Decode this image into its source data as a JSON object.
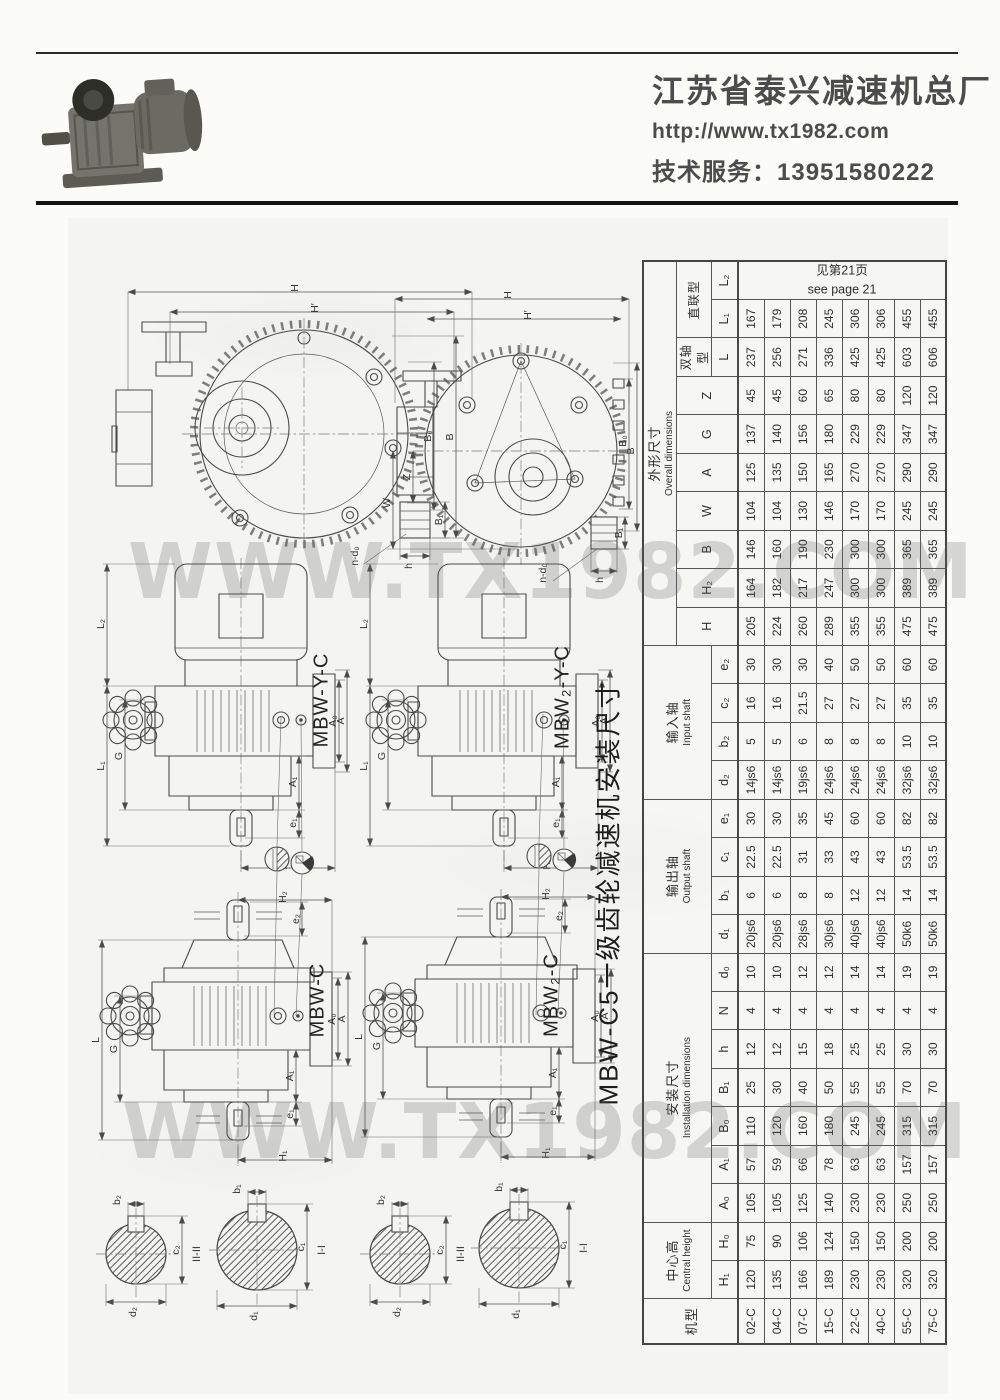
{
  "header": {
    "company": "江苏省泰兴减速机总厂",
    "website": "http://www.tx1982.com",
    "service": "技术服务：13951580222"
  },
  "watermark": "WWW.TX1982.COM",
  "title_vertical": "MBW-C5一级齿轮减速机安装尺寸",
  "drawings": {
    "labels": [
      "MBW-Y-C",
      "MBW₂-Y-C",
      "MBW-C",
      "MBW₂-C"
    ],
    "sections": [
      "II-II",
      "I-I"
    ],
    "dims": {
      "H": "H",
      "Hp": "H′",
      "B": "B",
      "B0": "B₀",
      "B1": "B₁",
      "h": "h",
      "nd0": "n-d₀",
      "Z": "Z",
      "W": "W",
      "L": "L",
      "L1": "L₁",
      "L2": "L₂",
      "G": "G",
      "A": "A",
      "A0": "A₀",
      "A1": "A₁",
      "e1": "e₁",
      "e2": "e₂",
      "H1": "H₁",
      "H2": "H₂",
      "b1": "b₁",
      "b2": "b₂",
      "c1": "c₁",
      "c2": "c₂",
      "d1": "d₁",
      "d2": "d₂"
    }
  },
  "table": {
    "model_header": "机型",
    "groups": [
      {
        "cn": "中心高",
        "en": "Central height",
        "cols": [
          "H₁",
          "H₀"
        ]
      },
      {
        "cn": "安装尺寸",
        "en": "Installation dimensions",
        "cols": [
          "A₀",
          "A₁",
          "B₀",
          "B₁",
          "h",
          "N",
          "d₀"
        ]
      },
      {
        "cn": "输出轴",
        "en": "Output shaft",
        "cols": [
          "d₁",
          "b₁",
          "c₁",
          "e₁"
        ]
      },
      {
        "cn": "输入轴",
        "en": "Input shaft",
        "cols": [
          "d₂",
          "b₂",
          "c₂",
          "e₂"
        ]
      },
      {
        "cn": "外形尺寸",
        "en": "Overall dimensions",
        "cols": [
          "H",
          "H₂",
          "B",
          "W",
          "A",
          "G",
          "Z"
        ]
      }
    ],
    "overall_sub": [
      {
        "cn": "双轴型",
        "cols": [
          "L"
        ]
      },
      {
        "cn": "直联型",
        "cols": [
          "L₁",
          "L₂"
        ]
      }
    ],
    "see_page": {
      "cn": "见第21页",
      "en": "see page 21"
    },
    "rows": [
      {
        "model": "02-C",
        "values": [
          "120",
          "75",
          "105",
          "57",
          "110",
          "25",
          "12",
          "4",
          "10",
          "20js6",
          "6",
          "22.5",
          "30",
          "14js6",
          "5",
          "16",
          "30",
          "205",
          "164",
          "146",
          "104",
          "125",
          "137",
          "45",
          "237",
          "167"
        ]
      },
      {
        "model": "04-C",
        "values": [
          "135",
          "90",
          "105",
          "59",
          "120",
          "30",
          "12",
          "4",
          "10",
          "20js6",
          "6",
          "22.5",
          "30",
          "14js6",
          "5",
          "16",
          "30",
          "224",
          "182",
          "160",
          "104",
          "135",
          "140",
          "45",
          "256",
          "179"
        ]
      },
      {
        "model": "07-C",
        "values": [
          "166",
          "106",
          "125",
          "66",
          "160",
          "40",
          "15",
          "4",
          "12",
          "28js6",
          "8",
          "31",
          "35",
          "19js6",
          "6",
          "21.5",
          "30",
          "260",
          "217",
          "190",
          "130",
          "150",
          "156",
          "60",
          "271",
          "208"
        ]
      },
      {
        "model": "15-C",
        "values": [
          "189",
          "124",
          "140",
          "78",
          "180",
          "50",
          "18",
          "4",
          "12",
          "30js6",
          "8",
          "33",
          "45",
          "24js6",
          "8",
          "27",
          "40",
          "289",
          "247",
          "230",
          "146",
          "165",
          "180",
          "65",
          "336",
          "245"
        ]
      },
      {
        "model": "22-C",
        "values": [
          "230",
          "150",
          "230",
          "63",
          "245",
          "55",
          "25",
          "4",
          "14",
          "40js6",
          "12",
          "43",
          "60",
          "24js6",
          "8",
          "27",
          "50",
          "355",
          "300",
          "300",
          "170",
          "270",
          "229",
          "80",
          "425",
          "306"
        ]
      },
      {
        "model": "40-C",
        "values": [
          "230",
          "150",
          "230",
          "63",
          "245",
          "55",
          "25",
          "4",
          "14",
          "40js6",
          "12",
          "43",
          "60",
          "24js6",
          "8",
          "27",
          "50",
          "355",
          "300",
          "300",
          "170",
          "270",
          "229",
          "80",
          "425",
          "306"
        ]
      },
      {
        "model": "55-C",
        "values": [
          "320",
          "200",
          "250",
          "157",
          "315",
          "70",
          "30",
          "4",
          "19",
          "50k6",
          "14",
          "53.5",
          "82",
          "32js6",
          "10",
          "35",
          "60",
          "475",
          "389",
          "365",
          "245",
          "290",
          "347",
          "120",
          "603",
          "455"
        ]
      },
      {
        "model": "75-C",
        "values": [
          "320",
          "200",
          "250",
          "157",
          "315",
          "70",
          "30",
          "4",
          "19",
          "50k6",
          "14",
          "53.5",
          "82",
          "32js6",
          "10",
          "35",
          "60",
          "475",
          "389",
          "365",
          "245",
          "290",
          "347",
          "120",
          "606",
          "455"
        ]
      }
    ]
  }
}
